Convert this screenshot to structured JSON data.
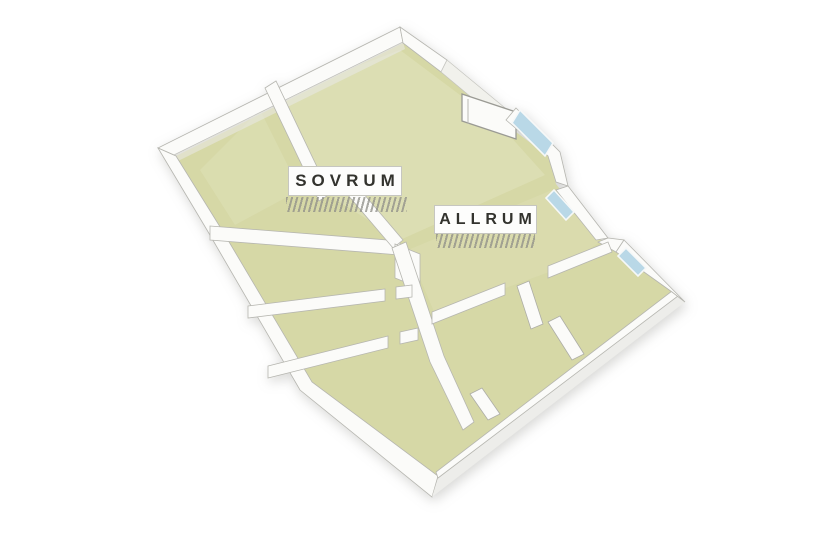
{
  "app": {
    "view_title": "3D floor plan"
  },
  "rooms": [
    {
      "id": "sovrum",
      "label": "SOVRUM"
    },
    {
      "id": "allrum",
      "label": "ALLRUM"
    }
  ],
  "features": {
    "entrance_door_count": 1,
    "window_count": 3
  },
  "colors": {
    "background": "#ffffff",
    "floor": "#d6d8a6",
    "floor_light": "#e7e8c9",
    "wall": "#fbfbf9",
    "wall_shade": "#e7e7e2",
    "wall_line": "#b6b6b0",
    "porch": "#f1f1ec",
    "glass": "#b9d8e7",
    "label_bg": "#fdfdfc",
    "label_text": "#33332e",
    "shadow_hatch": "#8e8e88"
  }
}
